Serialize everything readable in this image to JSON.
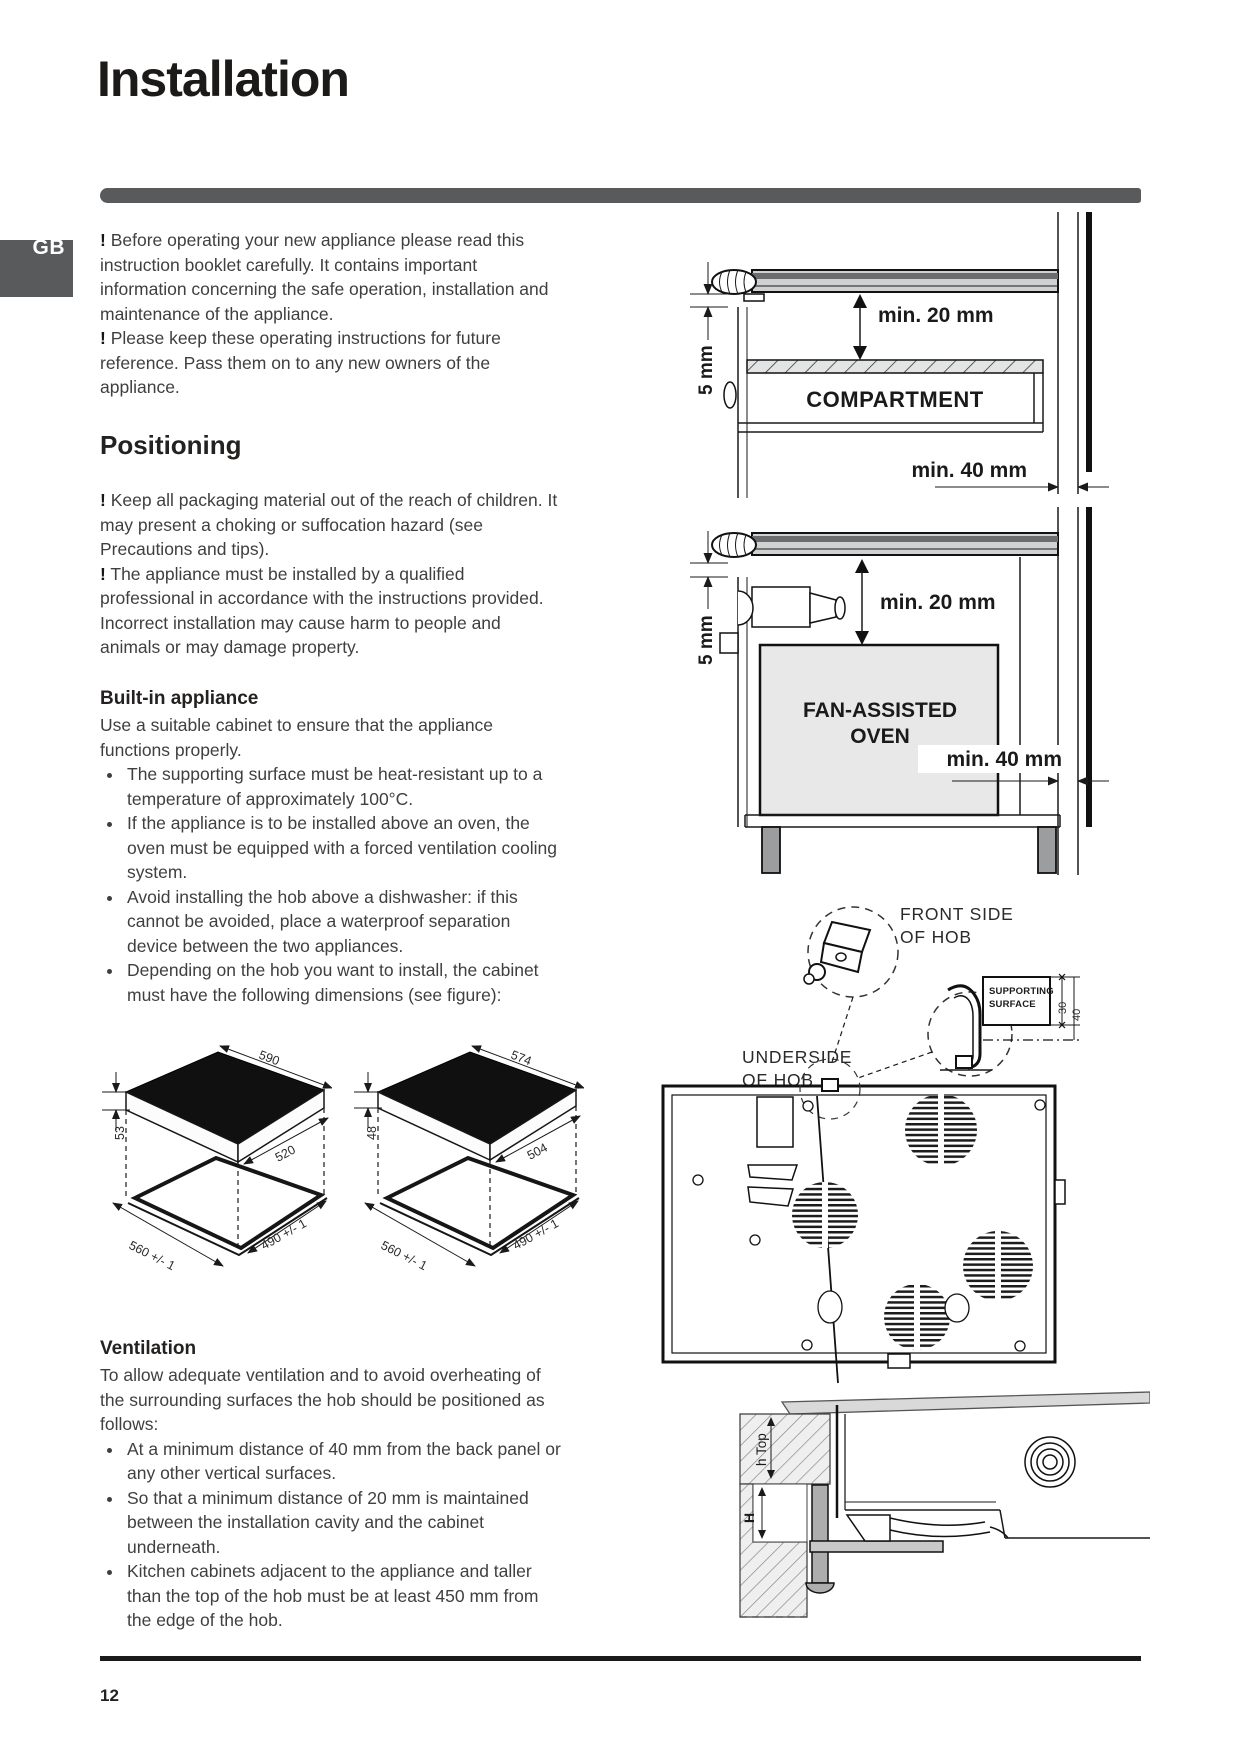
{
  "page": {
    "title": "Installation",
    "lang_tab": "GB",
    "page_number": "12",
    "bang": "!"
  },
  "intro": {
    "p1": "Before operating your new appliance please read this instruction booklet carefully. It contains important information concerning the safe operation, installation and maintenance of the appliance.",
    "p2": "Please keep these operating instructions for future reference. Pass them on to any new owners of the appliance."
  },
  "positioning": {
    "heading": "Positioning",
    "p1": "Keep all packaging material out of the reach of children. It may present a choking or suffocation hazard (see Precautions and tips).",
    "p2": "The appliance must be installed by a qualified professional in accordance with the instructions provided. Incorrect installation may cause harm to people and animals or may damage property."
  },
  "built_in": {
    "heading": "Built-in appliance",
    "intro": "Use a suitable cabinet to ensure that the appliance functions properly.",
    "bullets": [
      "The supporting surface must be heat-resistant up to a temperature of approximately 100°C.",
      "If the appliance is to be installed above an oven, the oven must be equipped with a forced ventilation cooling system.",
      "Avoid installing the hob above a dishwasher: if this cannot be avoided, place a waterproof separation device between the two appliances.",
      "Depending on the hob you want to install, the cabinet must have the following dimensions (see figure):"
    ]
  },
  "ventilation": {
    "heading": "Ventilation",
    "intro": "To allow adequate ventilation and to avoid overheating of the surrounding surfaces the hob should be positioned as follows:",
    "bullets": [
      "At a minimum distance of 40 mm from the back panel or any other vertical surfaces.",
      "So that a minimum distance of 20 mm is maintained between the installation cavity and the cabinet underneath.",
      "Kitchen cabinets adjacent to the appliance and taller than the top of the hob must be at least 450 mm from the edge of the hob."
    ]
  },
  "figures": {
    "compartment": {
      "gap": "5 mm",
      "clearance_top": "min. 20 mm",
      "label": "COMPARTMENT",
      "clearance_back": "min. 40 mm"
    },
    "oven": {
      "gap": "5 mm",
      "clearance_top": "min. 20 mm",
      "label_line1": "FAN-ASSISTED",
      "label_line2": "OVEN",
      "clearance_back": "min. 40 mm"
    },
    "hob_left": {
      "width": "590",
      "depth": "520",
      "height": "53",
      "cutout_width": "560 +/- 1",
      "cutout_depth": "490 +/- 1"
    },
    "hob_right": {
      "width": "574",
      "depth": "504",
      "height": "48",
      "cutout_width": "560 +/- 1",
      "cutout_depth": "490 +/- 1"
    },
    "mounting": {
      "front_line1": "FRONT SIDE",
      "front_line2": "OF HOB",
      "support_line1": "SUPPORTING",
      "support_line2": "SURFACE",
      "dim_30": "30",
      "dim_40": "40",
      "under_line1": "UNDERSIDE",
      "under_line2": "OF HOB"
    },
    "section": {
      "h_top": "h Top",
      "h": "H"
    }
  }
}
